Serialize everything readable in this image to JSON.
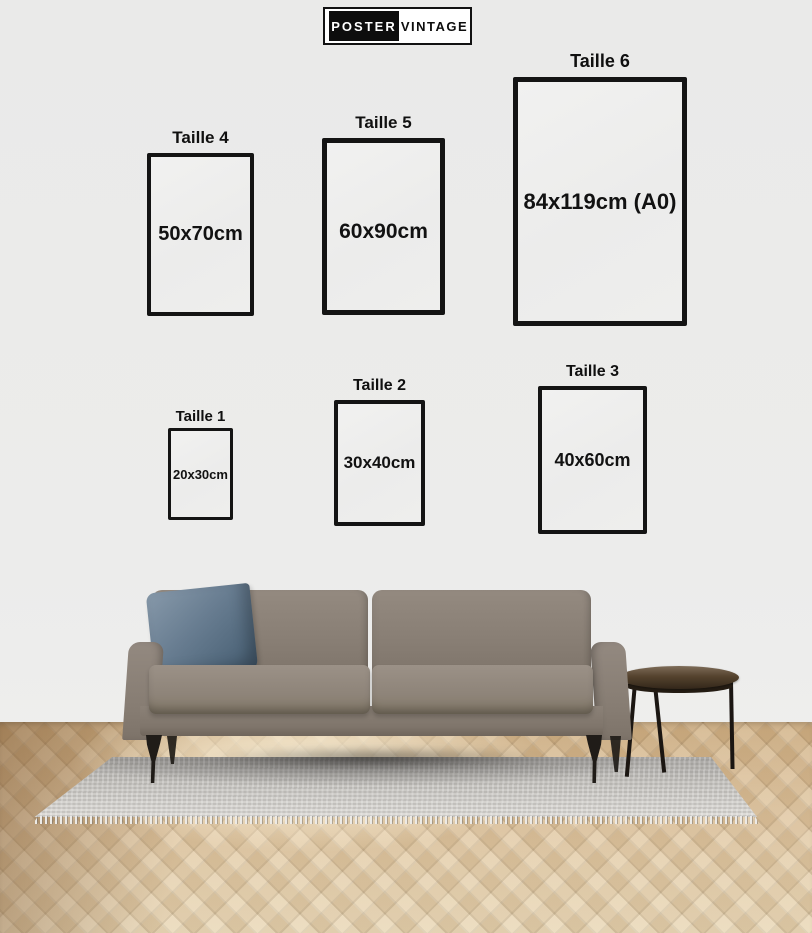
{
  "brand": {
    "logo_left": "POSTER",
    "logo_right": "VINTAGE"
  },
  "sizes": [
    {
      "label": "Taille 4",
      "dimensions": "50x70cm"
    },
    {
      "label": "Taille 5",
      "dimensions": "60x90cm"
    },
    {
      "label": "Taille 6",
      "dimensions": "84x119cm (A0)"
    },
    {
      "label": "Taille 1",
      "dimensions": "20x30cm"
    },
    {
      "label": "Taille 2",
      "dimensions": "30x40cm"
    },
    {
      "label": "Taille 3",
      "dimensions": "40x60cm"
    }
  ],
  "scene": {
    "wall_color": "#ececeb",
    "frame_border_color": "#141414",
    "frame_fill_color": "#efefee",
    "sofa_color": "#8a8076",
    "pillow_color": "#5f7488",
    "rug_color": "#c6c4c0",
    "floor_color": "#e0c6a0",
    "table_top_color": "#55432e",
    "leg_color": "#1d1915",
    "logo_bg_color": "#0d0d0d"
  }
}
